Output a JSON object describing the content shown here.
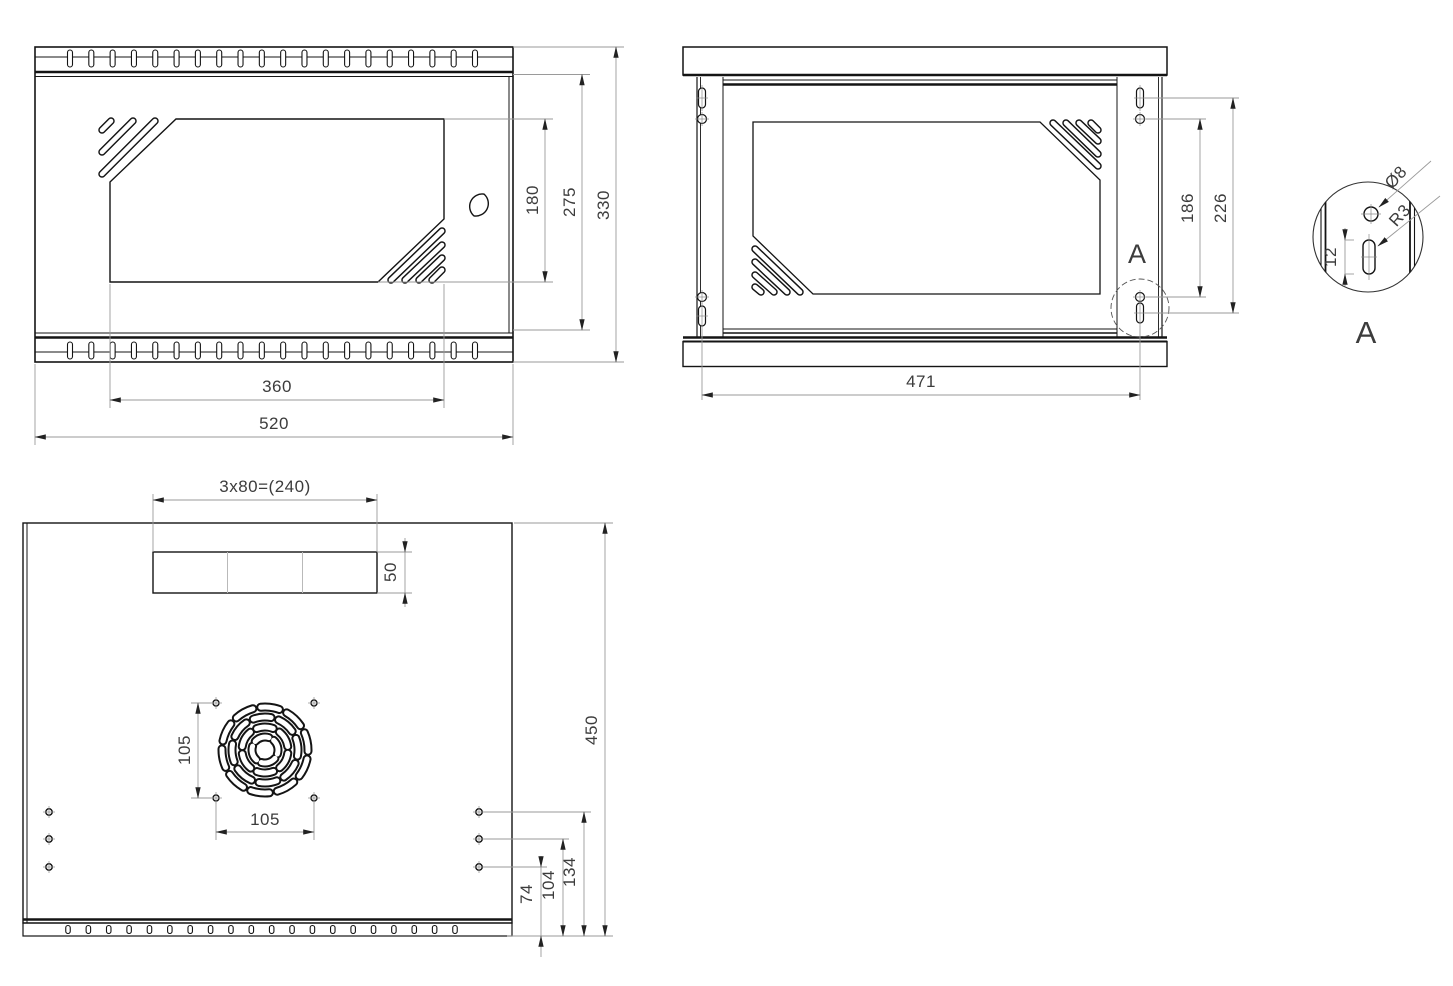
{
  "views": {
    "front": {
      "title": "front-view",
      "dims": {
        "overall_width": "520",
        "window_width": "360",
        "overall_height": "330",
        "body_height": "275",
        "window_height": "180"
      }
    },
    "rear": {
      "title": "rear-view",
      "detail_marker": "A",
      "dims": {
        "mounting_width": "471",
        "hole_spacing": "186",
        "slot_spacing": "226"
      }
    },
    "detail": {
      "title": "detail-a",
      "label": "A",
      "dims": {
        "slot_height": "12",
        "hole_diameter": "Ø8",
        "slot_radius": "R3"
      }
    },
    "top": {
      "title": "top-view",
      "dims": {
        "cable_cutout": "3x80=(240)",
        "cable_cutout_depth": "50",
        "fan_hole_spacing_v": "105",
        "fan_hole_spacing_h": "105",
        "overall_depth": "450",
        "side_hole_1": "74",
        "side_hole_2": "104",
        "side_hole_3": "134"
      }
    }
  },
  "colors": {
    "geometry": "#141414",
    "dimension_line": "#9a9a9a",
    "dimension_text": "#3c3c3c",
    "background": "#ffffff"
  }
}
